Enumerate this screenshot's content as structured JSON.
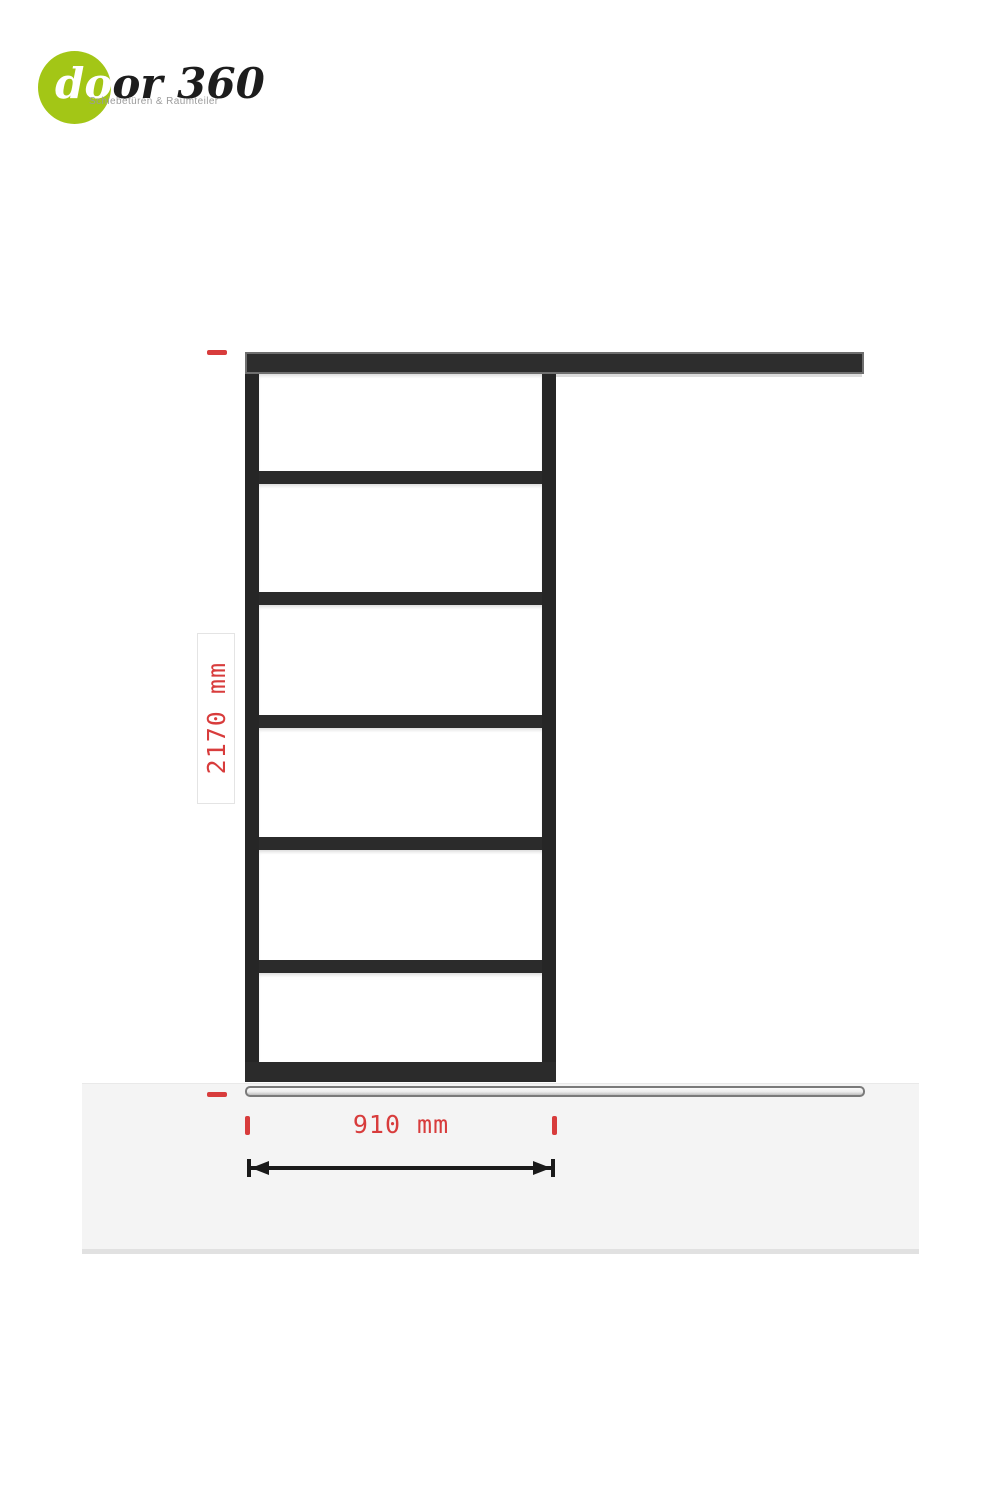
{
  "logo": {
    "brand_part1": "do",
    "brand_part2": "or 360",
    "tagline": "Schiebetüren & Raumteiler"
  },
  "diagram": {
    "description": "sliding-door elevation drawing with 6 glass panels",
    "panel_count": 6,
    "height_dimension": "2170 mm",
    "width_dimension": "910 mm",
    "colors": {
      "accent_red": "#d83c3c",
      "frame_dark": "#2b2b2b",
      "logo_green": "#a3c616",
      "floor_gray": "#f4f4f4"
    }
  }
}
